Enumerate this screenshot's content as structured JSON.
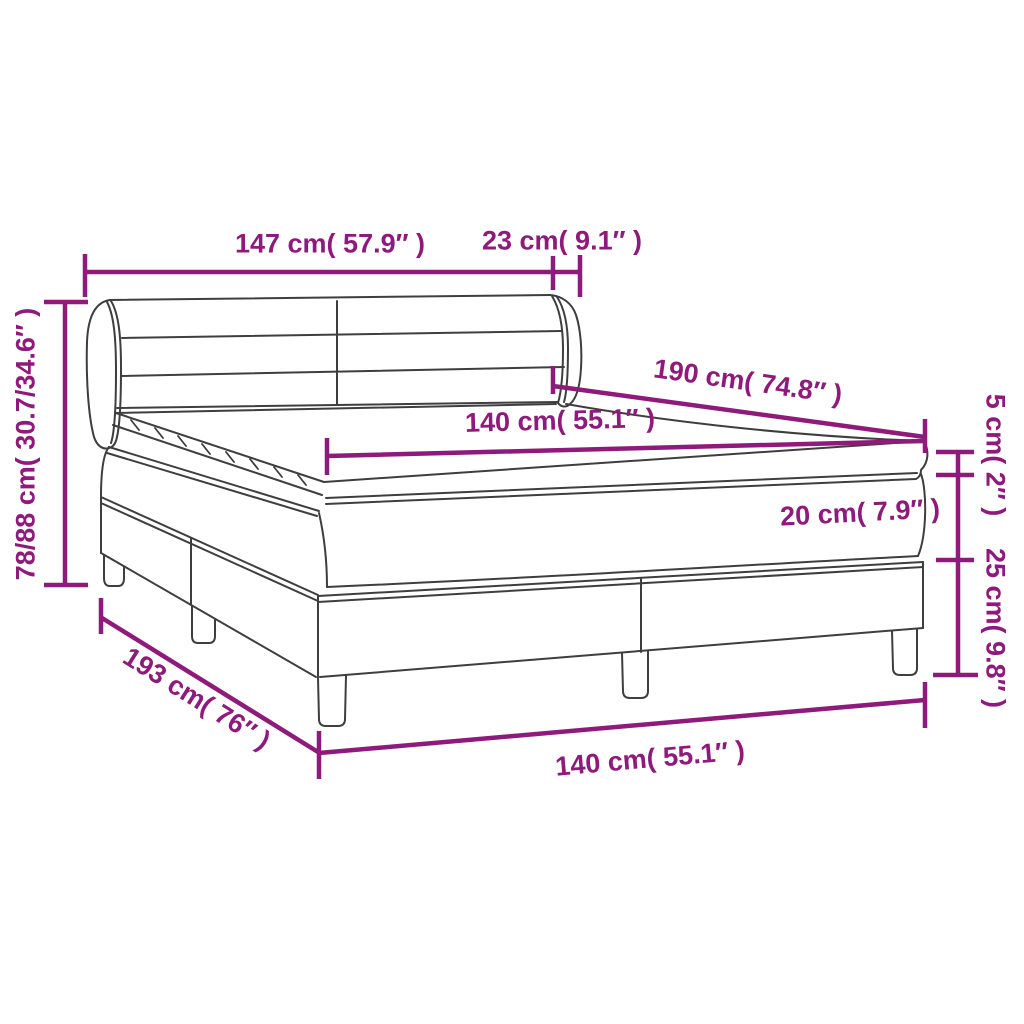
{
  "colors": {
    "dimension": "#8E1A7B",
    "outline": "#3E3E3E",
    "background": "#FFFFFF"
  },
  "diagram": {
    "subject": "box-spring-bed-with-headboard-mattress-and-topper",
    "dimensions": {
      "headboard_width": {
        "label": "147 cm( 57.9″ )"
      },
      "wing_depth": {
        "label": "23 cm( 9.1″ )"
      },
      "total_height": {
        "label": "78/88 cm( 30.7/34.6″ )"
      },
      "bed_length": {
        "label": "190 cm( 74.8″ )"
      },
      "mattress_width": {
        "label": "140 cm( 55.1″ )"
      },
      "topper_thickness": {
        "label": "5 cm( 2″ )"
      },
      "mattress_thickness": {
        "label": "20 cm( 7.9″ )"
      },
      "base_height": {
        "label": "25 cm( 9.8″ )"
      },
      "base_length": {
        "label": "193 cm( 76″ )"
      },
      "base_width": {
        "label": "140 cm( 55.1″ )"
      }
    }
  }
}
